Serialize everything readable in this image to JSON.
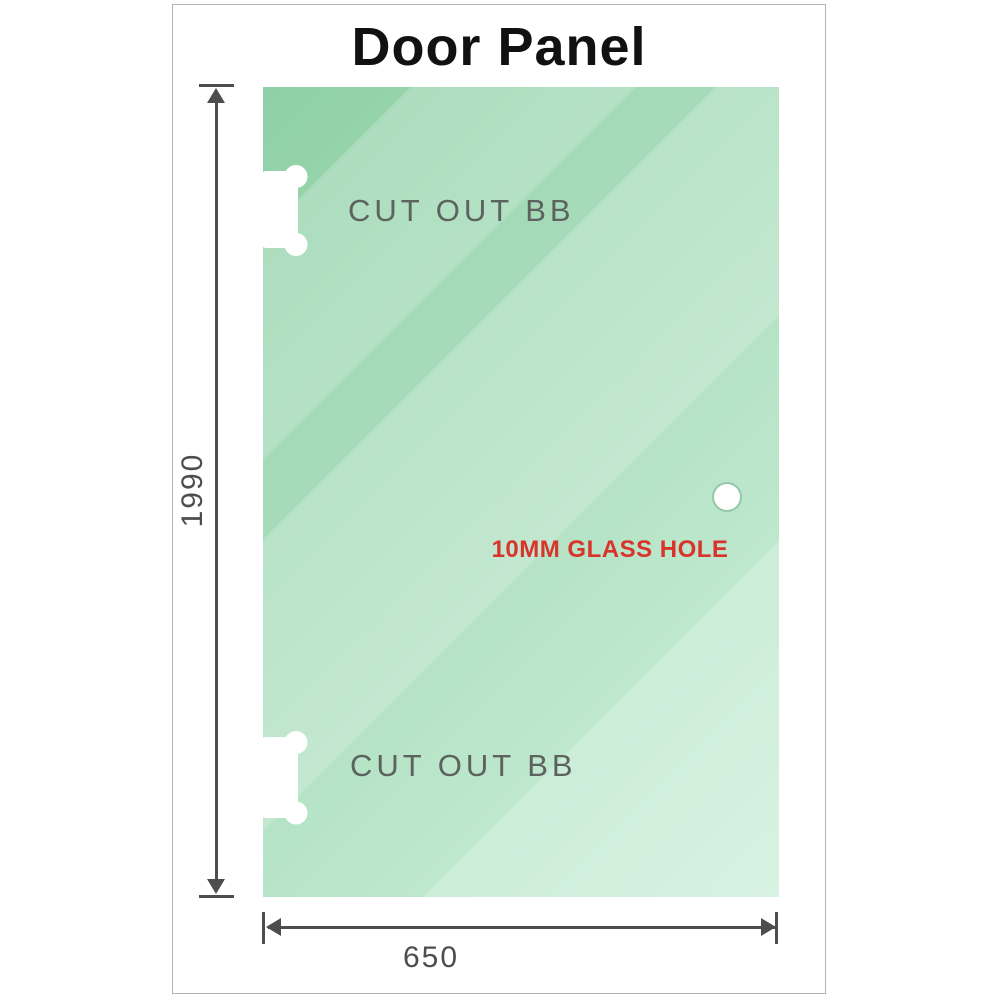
{
  "title": "Door Panel",
  "panel": {
    "cutout_top_label": "CUT OUT BB",
    "cutout_bottom_label": "CUT OUT BB",
    "hole_label": "10MM GLASS HOLE"
  },
  "dimensions": {
    "height": "1990",
    "width": "650"
  },
  "colors": {
    "glass-base-start": "#8fd0a6",
    "glass-base-end": "#c9eed7",
    "dimension": "#4d4d4d",
    "cutout-label": "#5c635f",
    "hole-label": "#d9342b",
    "frame-border": "#b3b3b3",
    "title": "#111111"
  }
}
